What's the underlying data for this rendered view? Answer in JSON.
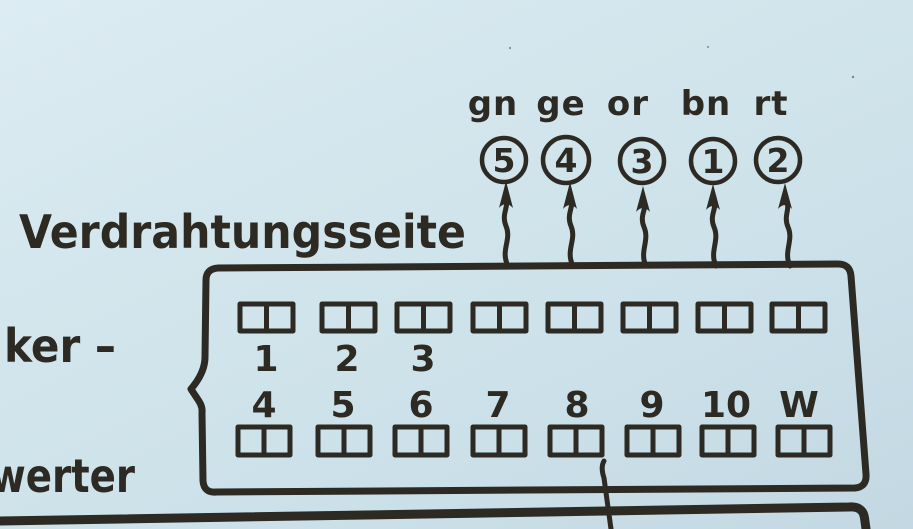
{
  "document": {
    "title": "Verdrahtungsseite",
    "left_text_fragments": {
      "upper": "ker –",
      "lower": "werter"
    }
  },
  "wire_callouts": {
    "items": [
      {
        "code": "gn",
        "terminal": "5"
      },
      {
        "code": "ge",
        "terminal": "4"
      },
      {
        "code": "or",
        "terminal": "3"
      },
      {
        "code": "bn",
        "terminal": "1"
      },
      {
        "code": "rt",
        "terminal": "2"
      }
    ]
  },
  "connector": {
    "top_row_labels": [
      "1",
      "2",
      "3"
    ],
    "bottom_row_labels": [
      "4",
      "5",
      "6",
      "7",
      "8",
      "9",
      "10",
      "W"
    ]
  },
  "icons": {
    "callout_arrow": "wavy-up-arrow-icon"
  },
  "colors": {
    "paper": "#cfe2ea",
    "ink": "#2d2a23"
  }
}
